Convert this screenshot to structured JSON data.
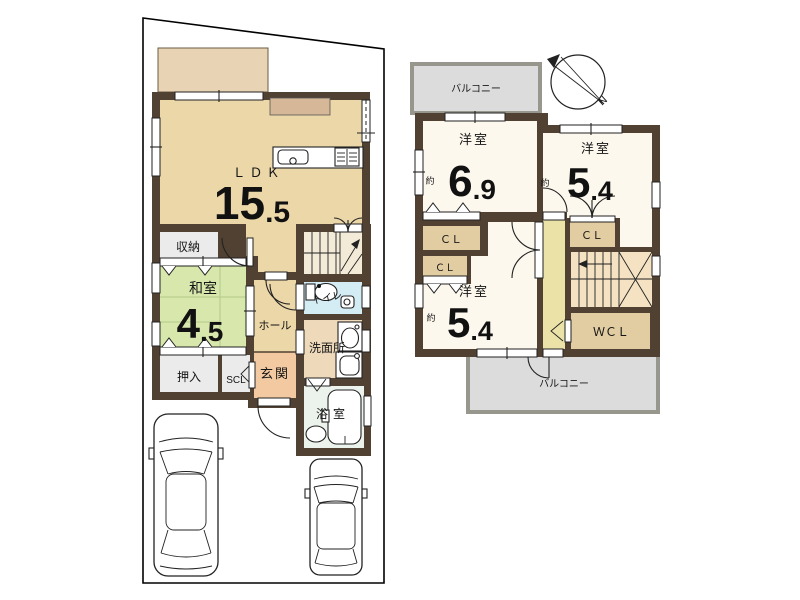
{
  "plan": {
    "type": "floor-plan",
    "colors": {
      "wall": "#514132",
      "ldk_floor": "#ecd7a9",
      "tatami": "#d8e8ac",
      "gray_storage": "#ebebeb",
      "genkan": "#f2c9a0",
      "toilet": "#d4ecf4",
      "washroom": "#eed9ba",
      "bath": "#ecf2ec",
      "cream_room": "#fdf8ee",
      "closet_tan": "#e2cda2",
      "hall2f": "#ebe2a8",
      "balcony": "#dcdcdc"
    }
  },
  "floor1": {
    "ldk": {
      "label": "ＬＤＫ",
      "size_int": "15",
      "size_dec": ".5"
    },
    "washitsu": {
      "label": "和室",
      "size_int": "4",
      "size_dec": ".5"
    },
    "storage": {
      "label": "収納"
    },
    "oshiire": {
      "label": "押入"
    },
    "scl": {
      "label": "SCL"
    },
    "genkan": {
      "label": "玄関"
    },
    "hall": {
      "label": "ホール"
    },
    "toilet": {
      "label": "トイレ"
    },
    "washroom": {
      "label": "洗面所"
    },
    "bathroom": {
      "label": "浴室"
    }
  },
  "floor2": {
    "bedroom1": {
      "label": "洋室",
      "approx": "約",
      "size_int": "6",
      "size_dec": ".9"
    },
    "bedroom2": {
      "label": "洋室",
      "approx": "約",
      "size_int": "5",
      "size_dec": ".4"
    },
    "bedroom3": {
      "label": "洋室",
      "approx": "約",
      "size_int": "5",
      "size_dec": ".4"
    },
    "closet1": {
      "label": "ＣＬ"
    },
    "closet2": {
      "label": "ＣＬ"
    },
    "closet3": {
      "label": "ＣＬ"
    },
    "wcl": {
      "label": "ＷＣＬ"
    },
    "balcony_top": {
      "label": "バルコニー"
    },
    "balcony_bottom": {
      "label": "バルコニー"
    },
    "compass": {
      "label": "N"
    }
  }
}
